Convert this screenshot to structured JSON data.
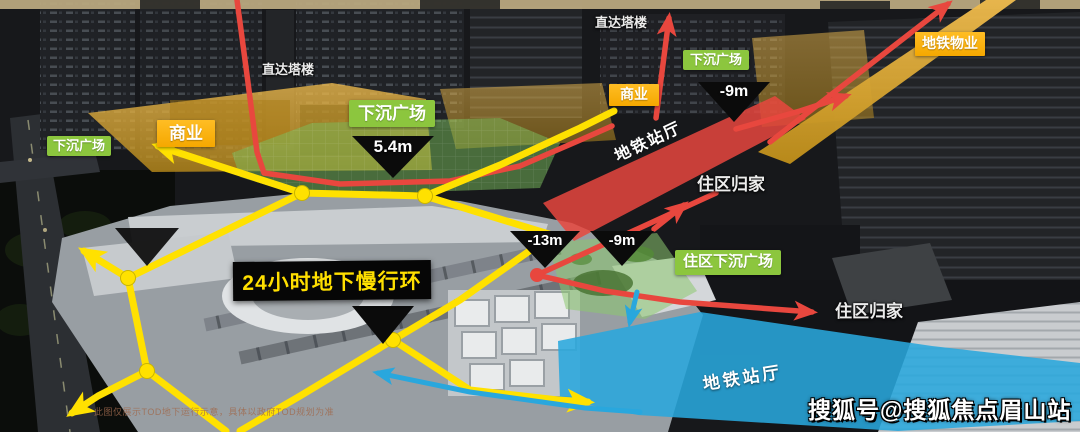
{
  "colors": {
    "path_yellow": "#ffe100",
    "route_red": "#e8473e",
    "metro_blue": "#29a7dd",
    "label_green": "#8cc63e",
    "label_yellow": "#f5a800",
    "banner_bg": "#060606",
    "banner_text": "#ffdf00"
  },
  "labels": {
    "direct_tower_left": "直达塔楼",
    "direct_tower_top": "直达塔楼",
    "sunken_plaza_left": "下沉广场",
    "sunken_plaza_center": "下沉广场",
    "sunken_plaza_top": "下沉广场",
    "residential_sunken_plaza": "住区下沉广场",
    "commercial_left": "商业",
    "commercial_center": "商业",
    "metro_property": "地铁物业",
    "residential_home_upper": "住区归家",
    "residential_home_lower": "住区归家",
    "metro_hall_upper": "地铁站厅",
    "metro_hall_lower": "地铁站厅"
  },
  "elevation_markers": {
    "plaza_depth": "5.4m",
    "upper_minus9": "-9m",
    "minus13": "-13m",
    "mid_minus9": "-9m"
  },
  "banner": {
    "text": "24小时地下慢行环"
  },
  "watermark": "搜狐号@搜狐焦点眉山站",
  "caption": "此图仅展示TOD地下运行示意，具体以政府TOD规划为准"
}
